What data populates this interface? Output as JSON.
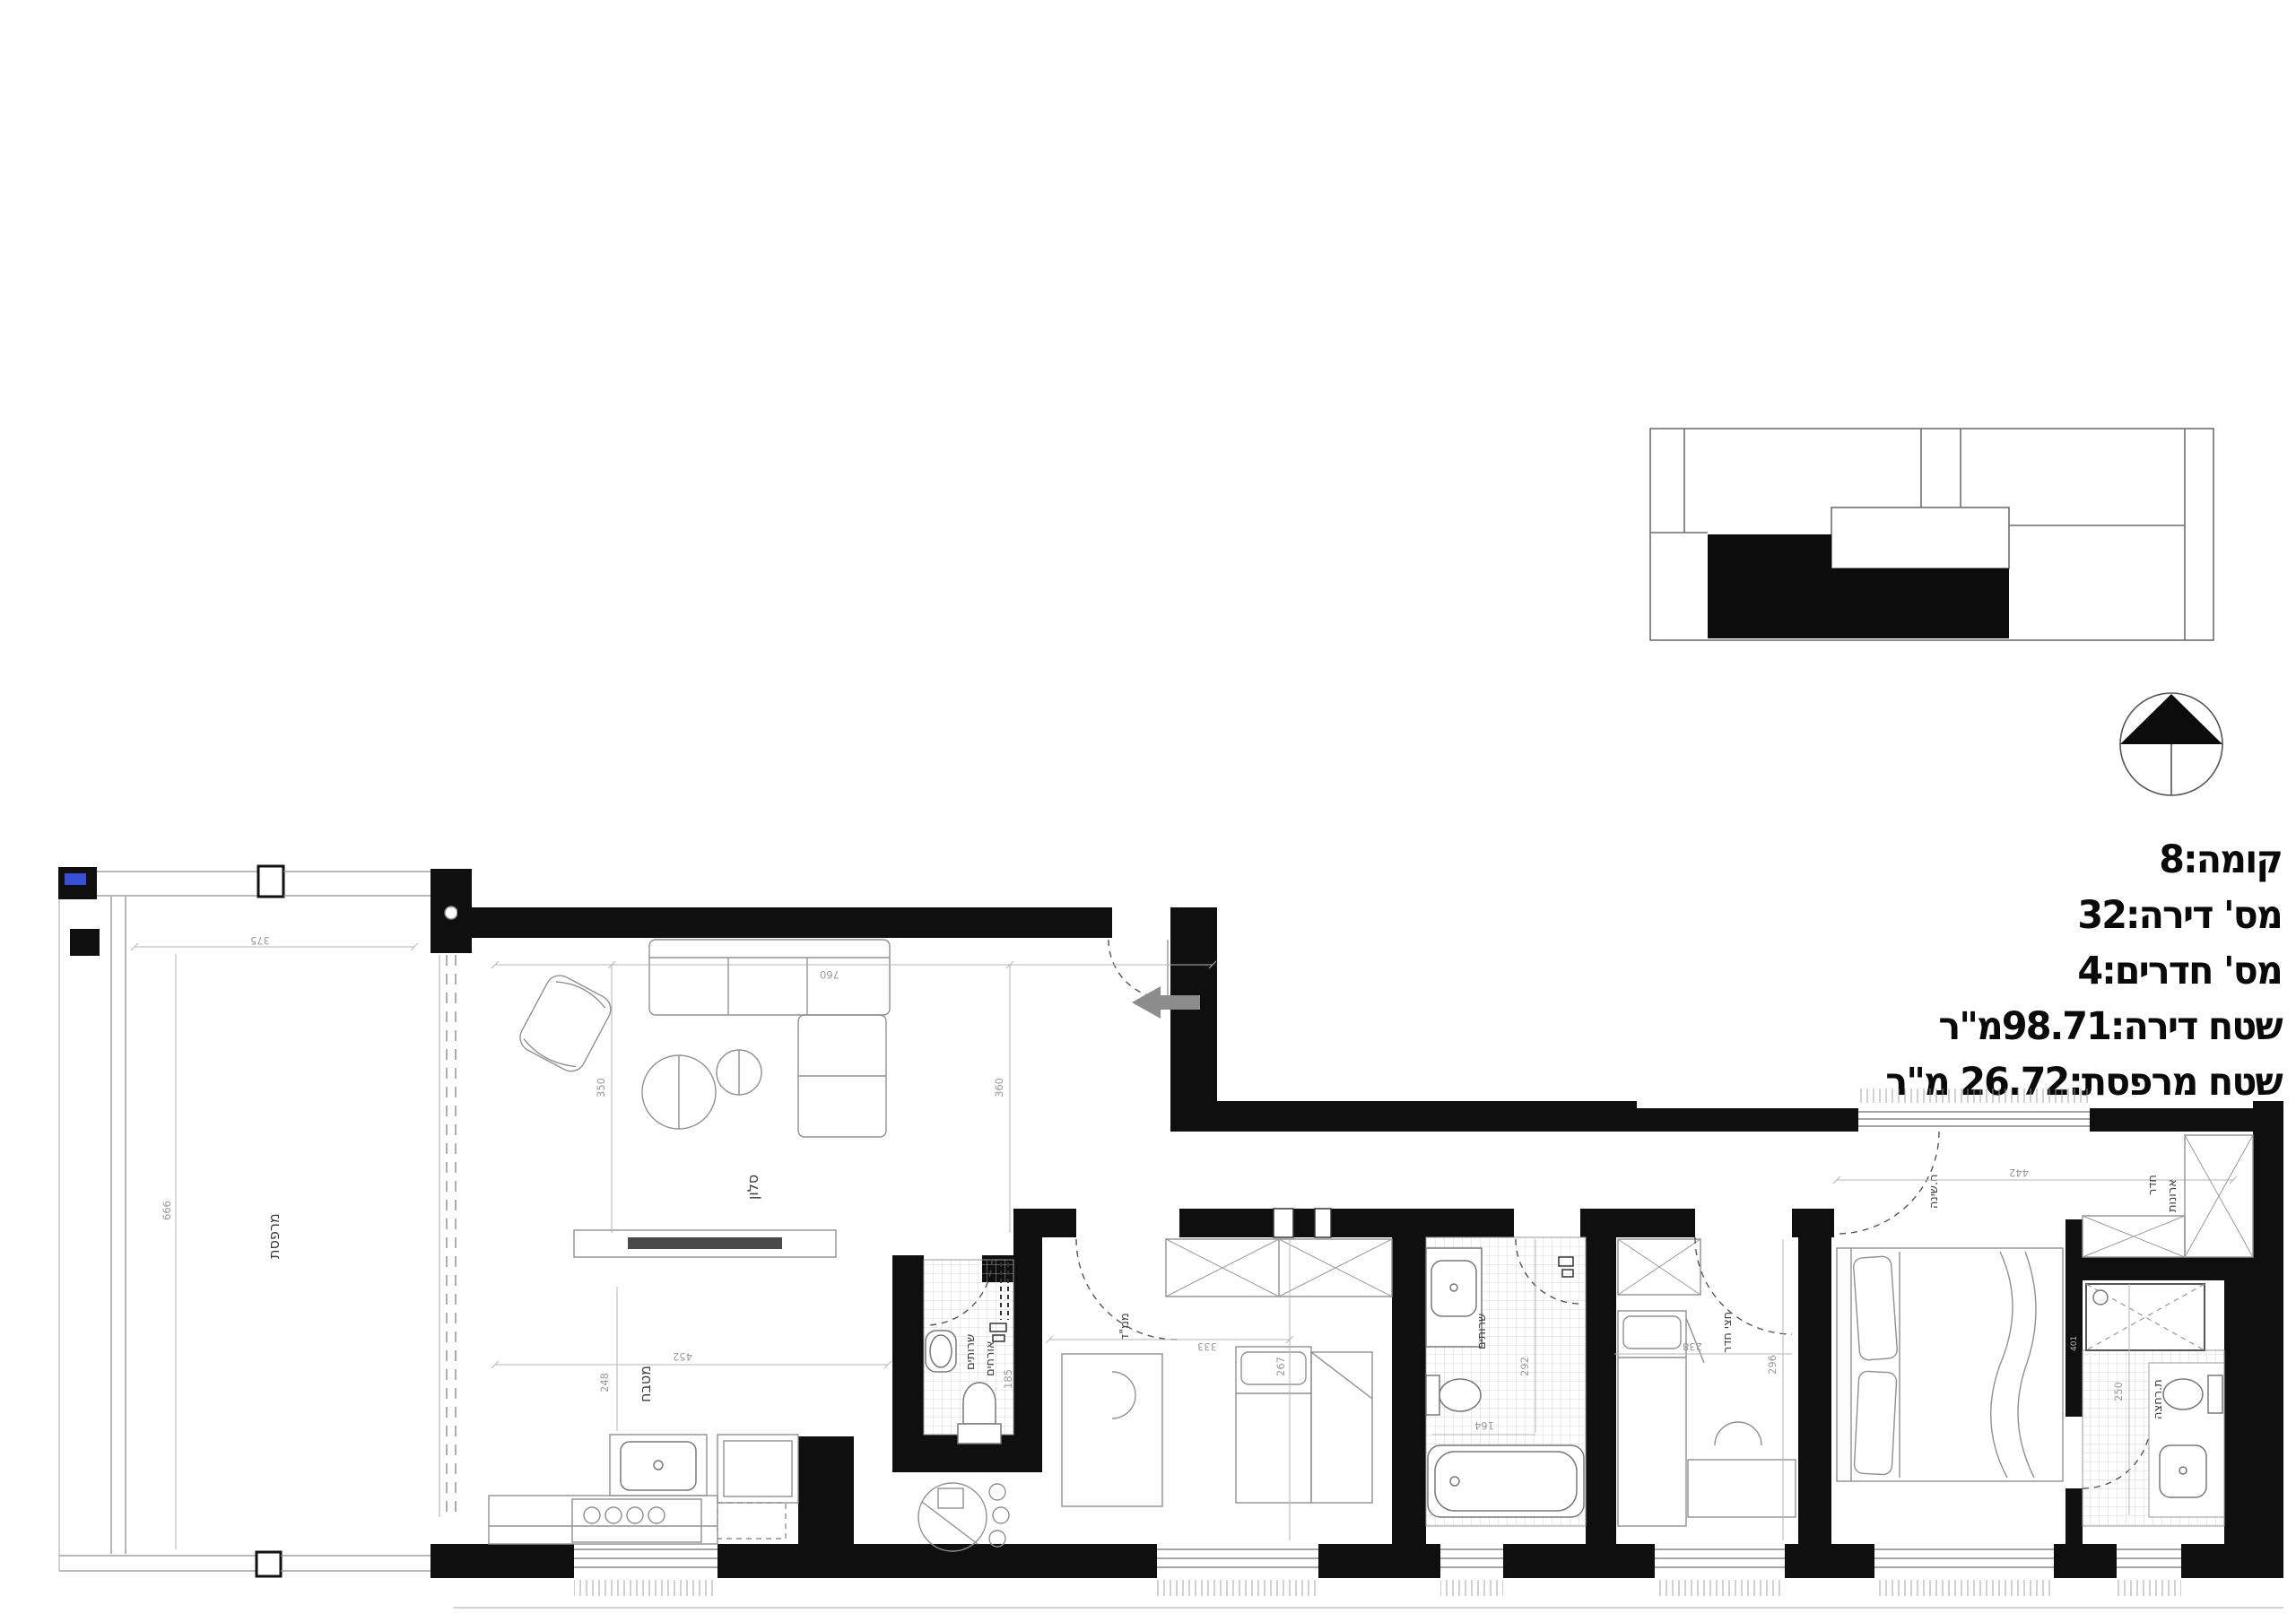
{
  "title_block": {
    "lines": [
      "קומה:8",
      "מס' דירה:32",
      "מס' חדרים:4",
      "שטח דירה:98.71מ\"ר",
      "שטח מרפסת:26.72 מ\"ר"
    ]
  },
  "rooms": {
    "balcony": "מרפסת",
    "living": "סלון",
    "kitchen": "מטבח",
    "wc_line1": "שרותים",
    "wc_line2": "אורחים",
    "mamad": "ממ\"ד",
    "bath": "שרותים",
    "half_room": "חצי חדר",
    "bedroom": "ח.שינה",
    "closet_line1": "חדר",
    "closet_line2": "ארונות",
    "shower": "ת.רחצה"
  },
  "dims": {
    "balcony_w": "375",
    "balcony_h": "666",
    "living_left": "350",
    "living_right": "360",
    "living_top": "760",
    "kitchen_w": "452",
    "kitchen_d": "248",
    "wc_d": "185",
    "mamad_w": "333",
    "mamad_d": "267",
    "bath_d": "292",
    "bath_w": "164",
    "half_w": "238",
    "half_d": "296",
    "bedroom_w": "442",
    "shower_d": "250",
    "wall_tag": "401"
  },
  "colors": {
    "wall": "#0f0f0f",
    "plan_line": "#8f8f8f",
    "dim_text": "#9a9a9a",
    "label_text": "#3d3d3d",
    "entry_arrow": "#8c8c8c",
    "marker_blue": "#3a4fd8"
  }
}
